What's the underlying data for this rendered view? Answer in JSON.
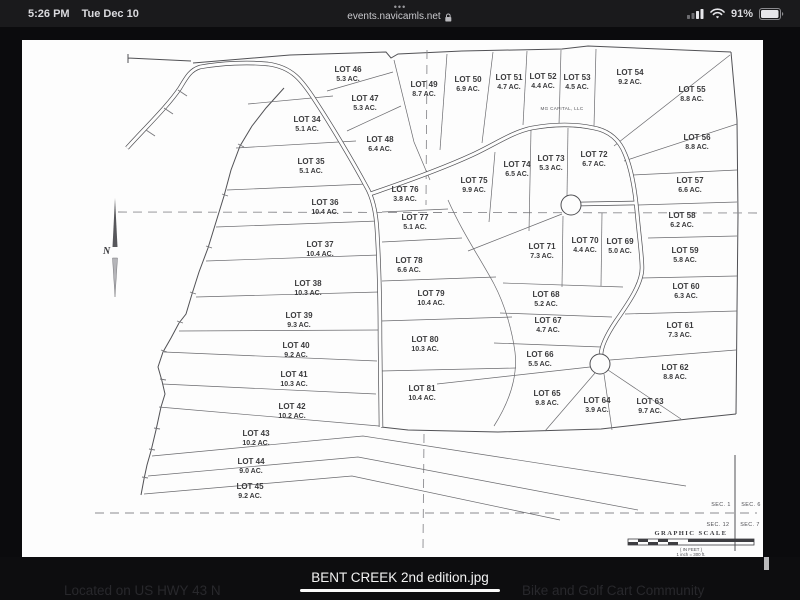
{
  "status_bar": {
    "time": "5:26 PM",
    "date": "Tue Dec 10",
    "tab_dots": "•••",
    "url": "events.navicamls.net",
    "battery_percent": "91%"
  },
  "map": {
    "colors": {
      "page_bg": "#fdfdfd",
      "ink": "#3b3b3d"
    },
    "north_label": "N",
    "owner_label": "MG CAPITAL, LLC",
    "graphic_scale_label": "GRAPHIC SCALE",
    "scale_note_feet": "( IN FEET )",
    "scale_note_inch": "1 inch = 300 ft.",
    "sections": [
      "SEC. 1",
      "SEC. 6",
      "SEC. 12",
      "SEC. 7"
    ],
    "lots": [
      {
        "n": "LOT 34",
        "a": "5.1 AC.",
        "x": 307,
        "y": 122
      },
      {
        "n": "LOT 35",
        "a": "5.1 AC.",
        "x": 311,
        "y": 164
      },
      {
        "n": "LOT 36",
        "a": "10.4 AC.",
        "x": 325,
        "y": 205
      },
      {
        "n": "LOT 37",
        "a": "10.4 AC.",
        "x": 320,
        "y": 247
      },
      {
        "n": "LOT 38",
        "a": "10.3 AC.",
        "x": 308,
        "y": 286
      },
      {
        "n": "LOT 39",
        "a": "9.3 AC.",
        "x": 299,
        "y": 318
      },
      {
        "n": "LOT 40",
        "a": "9.2 AC.",
        "x": 296,
        "y": 348
      },
      {
        "n": "LOT 41",
        "a": "10.3 AC.",
        "x": 294,
        "y": 377
      },
      {
        "n": "LOT 42",
        "a": "10.2 AC.",
        "x": 292,
        "y": 409
      },
      {
        "n": "LOT 43",
        "a": "10.2 AC.",
        "x": 256,
        "y": 436
      },
      {
        "n": "LOT 44",
        "a": "9.0 AC.",
        "x": 251,
        "y": 464
      },
      {
        "n": "LOT 45",
        "a": "9.2 AC.",
        "x": 250,
        "y": 489
      },
      {
        "n": "LOT 46",
        "a": "5.3 AC.",
        "x": 348,
        "y": 72
      },
      {
        "n": "LOT 47",
        "a": "5.3 AC.",
        "x": 365,
        "y": 101
      },
      {
        "n": "LOT 48",
        "a": "6.4 AC.",
        "x": 380,
        "y": 142
      },
      {
        "n": "LOT 49",
        "a": "8.7 AC.",
        "x": 424,
        "y": 87
      },
      {
        "n": "LOT 50",
        "a": "6.9 AC.",
        "x": 468,
        "y": 82
      },
      {
        "n": "LOT 51",
        "a": "4.7 AC.",
        "x": 509,
        "y": 80
      },
      {
        "n": "LOT 52",
        "a": "4.4 AC.",
        "x": 543,
        "y": 79
      },
      {
        "n": "LOT 53",
        "a": "4.5 AC.",
        "x": 577,
        "y": 80
      },
      {
        "n": "LOT 54",
        "a": "9.2 AC.",
        "x": 630,
        "y": 75
      },
      {
        "n": "LOT 55",
        "a": "8.8 AC.",
        "x": 692,
        "y": 92
      },
      {
        "n": "LOT 56",
        "a": "8.8 AC.",
        "x": 697,
        "y": 140
      },
      {
        "n": "LOT 57",
        "a": "6.6 AC.",
        "x": 690,
        "y": 183
      },
      {
        "n": "LOT 58",
        "a": "6.2 AC.",
        "x": 682,
        "y": 218
      },
      {
        "n": "LOT 59",
        "a": "5.8 AC.",
        "x": 685,
        "y": 253
      },
      {
        "n": "LOT 60",
        "a": "6.3 AC.",
        "x": 686,
        "y": 289
      },
      {
        "n": "LOT 61",
        "a": "7.3 AC.",
        "x": 680,
        "y": 328
      },
      {
        "n": "LOT 62",
        "a": "8.8 AC.",
        "x": 675,
        "y": 370
      },
      {
        "n": "LOT 63",
        "a": "9.7 AC.",
        "x": 650,
        "y": 404
      },
      {
        "n": "LOT 64",
        "a": "3.9 AC.",
        "x": 597,
        "y": 403
      },
      {
        "n": "LOT 65",
        "a": "9.8 AC.",
        "x": 547,
        "y": 396
      },
      {
        "n": "LOT 66",
        "a": "5.5 AC.",
        "x": 540,
        "y": 357
      },
      {
        "n": "LOT 67",
        "a": "4.7 AC.",
        "x": 548,
        "y": 323
      },
      {
        "n": "LOT 68",
        "a": "5.2 AC.",
        "x": 546,
        "y": 297
      },
      {
        "n": "LOT 69",
        "a": "5.0 AC.",
        "x": 620,
        "y": 244
      },
      {
        "n": "LOT 70",
        "a": "4.4 AC.",
        "x": 585,
        "y": 243
      },
      {
        "n": "LOT 71",
        "a": "7.3 AC.",
        "x": 542,
        "y": 249
      },
      {
        "n": "LOT 72",
        "a": "6.7 AC.",
        "x": 594,
        "y": 157
      },
      {
        "n": "LOT 73",
        "a": "5.3 AC.",
        "x": 551,
        "y": 161
      },
      {
        "n": "LOT 74",
        "a": "6.5 AC.",
        "x": 517,
        "y": 167
      },
      {
        "n": "LOT 75",
        "a": "9.9 AC.",
        "x": 474,
        "y": 183
      },
      {
        "n": "LOT 76",
        "a": "3.8 AC.",
        "x": 405,
        "y": 192
      },
      {
        "n": "LOT 77",
        "a": "5.1 AC.",
        "x": 415,
        "y": 220
      },
      {
        "n": "LOT 78",
        "a": "6.6 AC.",
        "x": 409,
        "y": 263
      },
      {
        "n": "LOT 79",
        "a": "10.4 AC.",
        "x": 431,
        "y": 296
      },
      {
        "n": "LOT 80",
        "a": "10.3 AC.",
        "x": 425,
        "y": 342
      },
      {
        "n": "LOT 81",
        "a": "10.4 AC.",
        "x": 422,
        "y": 391
      }
    ]
  },
  "footer": {
    "left_caption": "Located on US HWY 43 N",
    "filename": "BENT CREEK 2nd edition.jpg",
    "right_caption": "Bike and Golf Cart Community"
  }
}
